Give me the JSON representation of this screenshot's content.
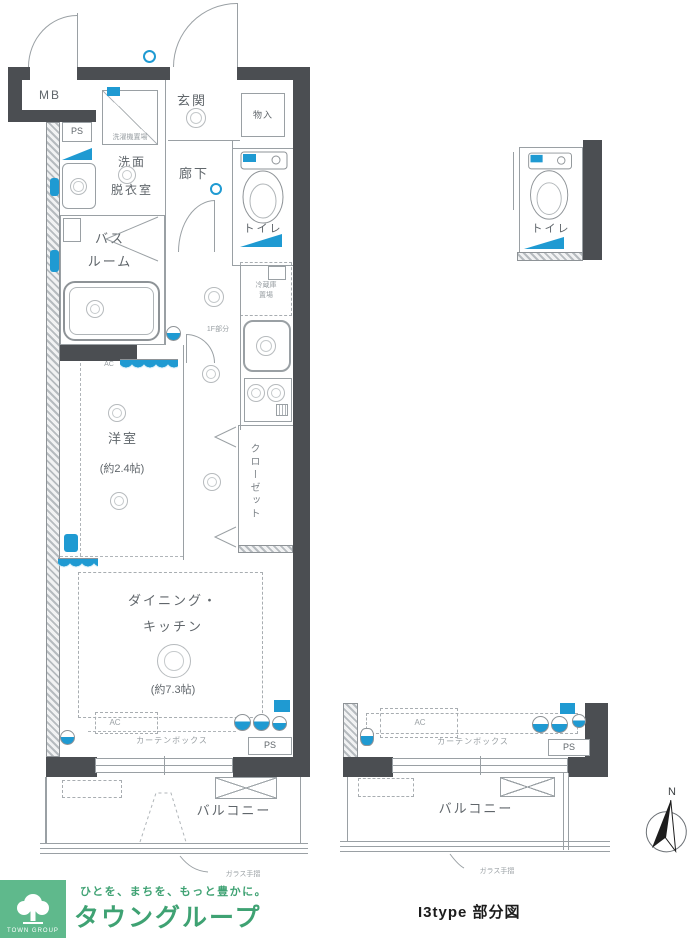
{
  "plan": {
    "labels": {
      "mb": "MB",
      "ps": "PS",
      "entrance": "玄関",
      "storage": "物入",
      "laundry": "洗濯機置場",
      "washroom_line1": "洗面",
      "washroom_line2": "脱衣室",
      "corridor": "廊下",
      "toilet": "トイレ",
      "bath_line1": "バス",
      "bath_line2": "ルーム",
      "fridge_line1": "冷蔵庫",
      "fridge_line2": "置場",
      "lowered_ceiling_note": "1F部分",
      "ac": "AC",
      "closet": "クローゼット",
      "western_room": "洋室",
      "western_room_size": "(約2.4帖)",
      "dk_line1": "ダイニング・",
      "dk_line2": "キッチン",
      "dk_size": "(約7.3帖)",
      "curtain_box": "カーテンボックス",
      "balcony": "バルコニー",
      "glass_rail": "ガラス手摺"
    },
    "compass_north": "N"
  },
  "footer": {
    "caption": "I3type 部分図",
    "logo_tagline": "ひとを、まちを、もっと豊かに。",
    "logo_name": "タウングループ",
    "logo_mark_text": "TOWN GROUP"
  },
  "colors": {
    "accent_blue": "#1f9ad2",
    "wall_gray": "#4b4e52",
    "brand_green": "#3fa273"
  }
}
